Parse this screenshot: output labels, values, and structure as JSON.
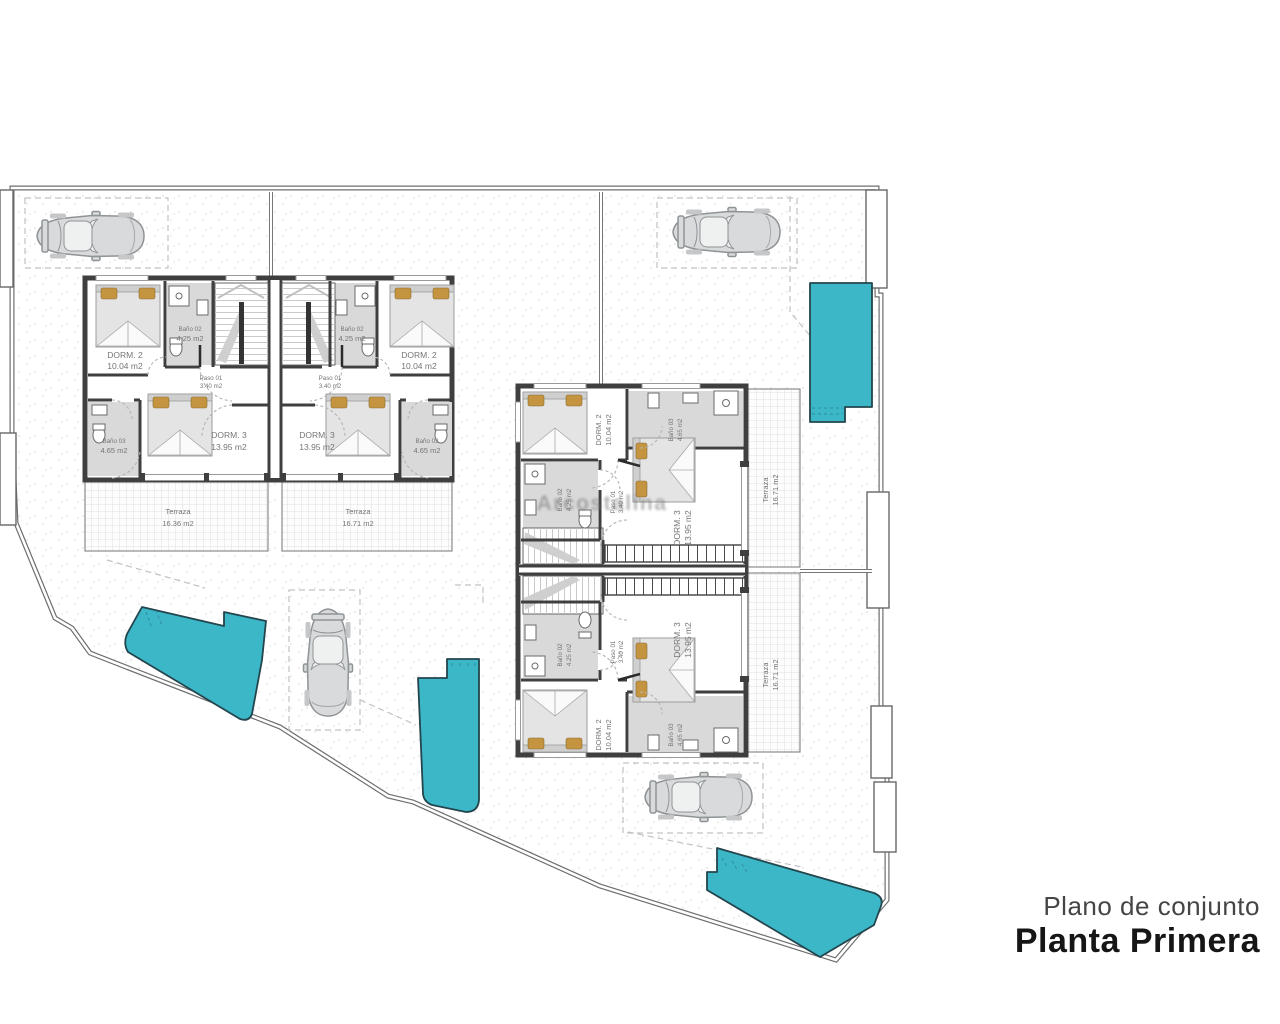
{
  "title": {
    "subtitle": "Plano de conjunto",
    "main": "Planta Primera"
  },
  "watermark": {
    "text": "Arcostalina"
  },
  "rooms": {
    "dorm2": {
      "name": "DORM. 2",
      "area": "10.04 m2"
    },
    "dorm3": {
      "name": "DORM. 3",
      "area": "13.95 m2"
    },
    "bano02": {
      "name": "Baño 02",
      "area": "4.25 m2"
    },
    "bano03": {
      "name": "Baño 03",
      "area": "4.65 m2"
    },
    "paso": {
      "name": "Paso 01",
      "area": "3.40 m2"
    },
    "terraza_a": {
      "name": "Terraza",
      "area": "16.36 m2"
    },
    "terraza_b": {
      "name": "Terraza",
      "area": "16.71 m2"
    }
  },
  "colors": {
    "pool": "#3cb7c8",
    "poolstroke": "#23454d",
    "wall": "#3f3f3f",
    "bath": "#d9d9d9",
    "bed": "#e4e4e4",
    "pillow": "#c59440",
    "label": "#757575",
    "boundary": "#6e6e6e",
    "dash": "#c2c2c2",
    "title": "#161616",
    "subtitle": "#454545"
  }
}
